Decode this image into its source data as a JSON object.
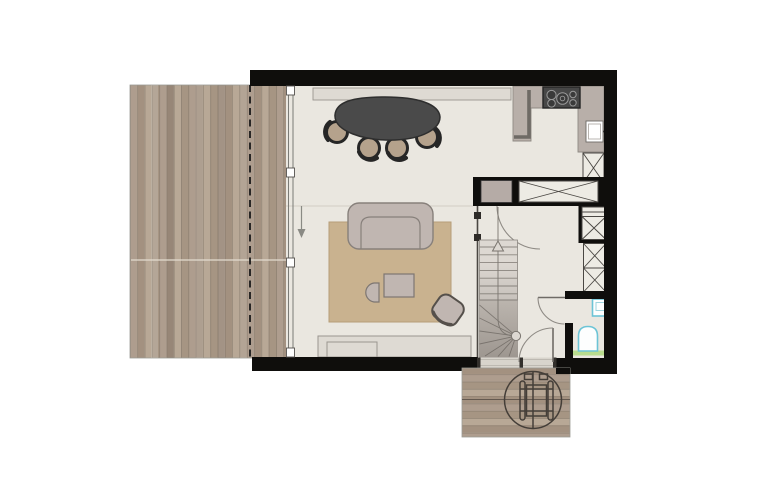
{
  "meta": {
    "kind": "architectural floor plan, plan view, no text labels visible",
    "style": "rendered plan with black walls, wood decking, beige interior",
    "canvas": {
      "width_px": 766,
      "height_px": 500,
      "background": "#ffffff"
    }
  },
  "colors": {
    "c-wall": "#0f0e0c",
    "c-floor": "#eae7e0",
    "c-floor-line": "#c9c4bb",
    "c-plank-a": "#ae9d8e",
    "c-plank-b": "#a39180",
    "c-plank-c": "#b8a896",
    "c-plank-d": "#a69583",
    "c-plank-line": "#8a7c6d",
    "c-rug": "#c9b28f",
    "c-rug-line": "#b69e79",
    "c-sofa": "#c0b6b1",
    "c-sofa-line": "#87807b",
    "c-table": "#4a4a4a",
    "c-table-line": "#2e2e2e",
    "c-seat": "#b5a28c",
    "c-ring": "#262626",
    "c-counter": "#b8afa9",
    "c-counter-edge": "#6e6a65",
    "c-cab": "#edebe4",
    "c-cab-line": "#4a4743",
    "c-appliance": "#b5aba6",
    "c-stair": "#ddd8d2",
    "c-stair-low": "#cfc9c2",
    "c-stair-line": "#8b8680",
    "c-door": "#8f8b85",
    "c-glass": "#7b7b76",
    "c-threshold": "#d8d4cc",
    "c-fixture": "#6cc4d6",
    "c-strip": "#b9dc8e",
    "c-symbol": "#443e38",
    "c-band": "#dedad3",
    "c-band-line": "#9a958f",
    "c-white": "#ffffff"
  },
  "inventory": {
    "zones": [
      "wood-deck-terrace-left",
      "open-living-dining-kitchen",
      "stair-hall",
      "wc-bathroom",
      "entrance-porch-deck"
    ],
    "symbols": {
      "dining_table_seats_visible": 4,
      "cooktop_burners": 4,
      "kitchen_sink": 1,
      "x_marked_storage_units": 6,
      "stair_straight_treads": 8,
      "stair_winder_treads": 7,
      "stair_direction_arrow": "up",
      "swing_doors": 3,
      "sliding_glass_facade_arrow": "down",
      "wc_toilet": 1,
      "wc_hand_basin": 1,
      "wheelchair_turning_circle_on_porch": 1,
      "roof_overhang_dashed_line_on_deck": 1
    }
  }
}
